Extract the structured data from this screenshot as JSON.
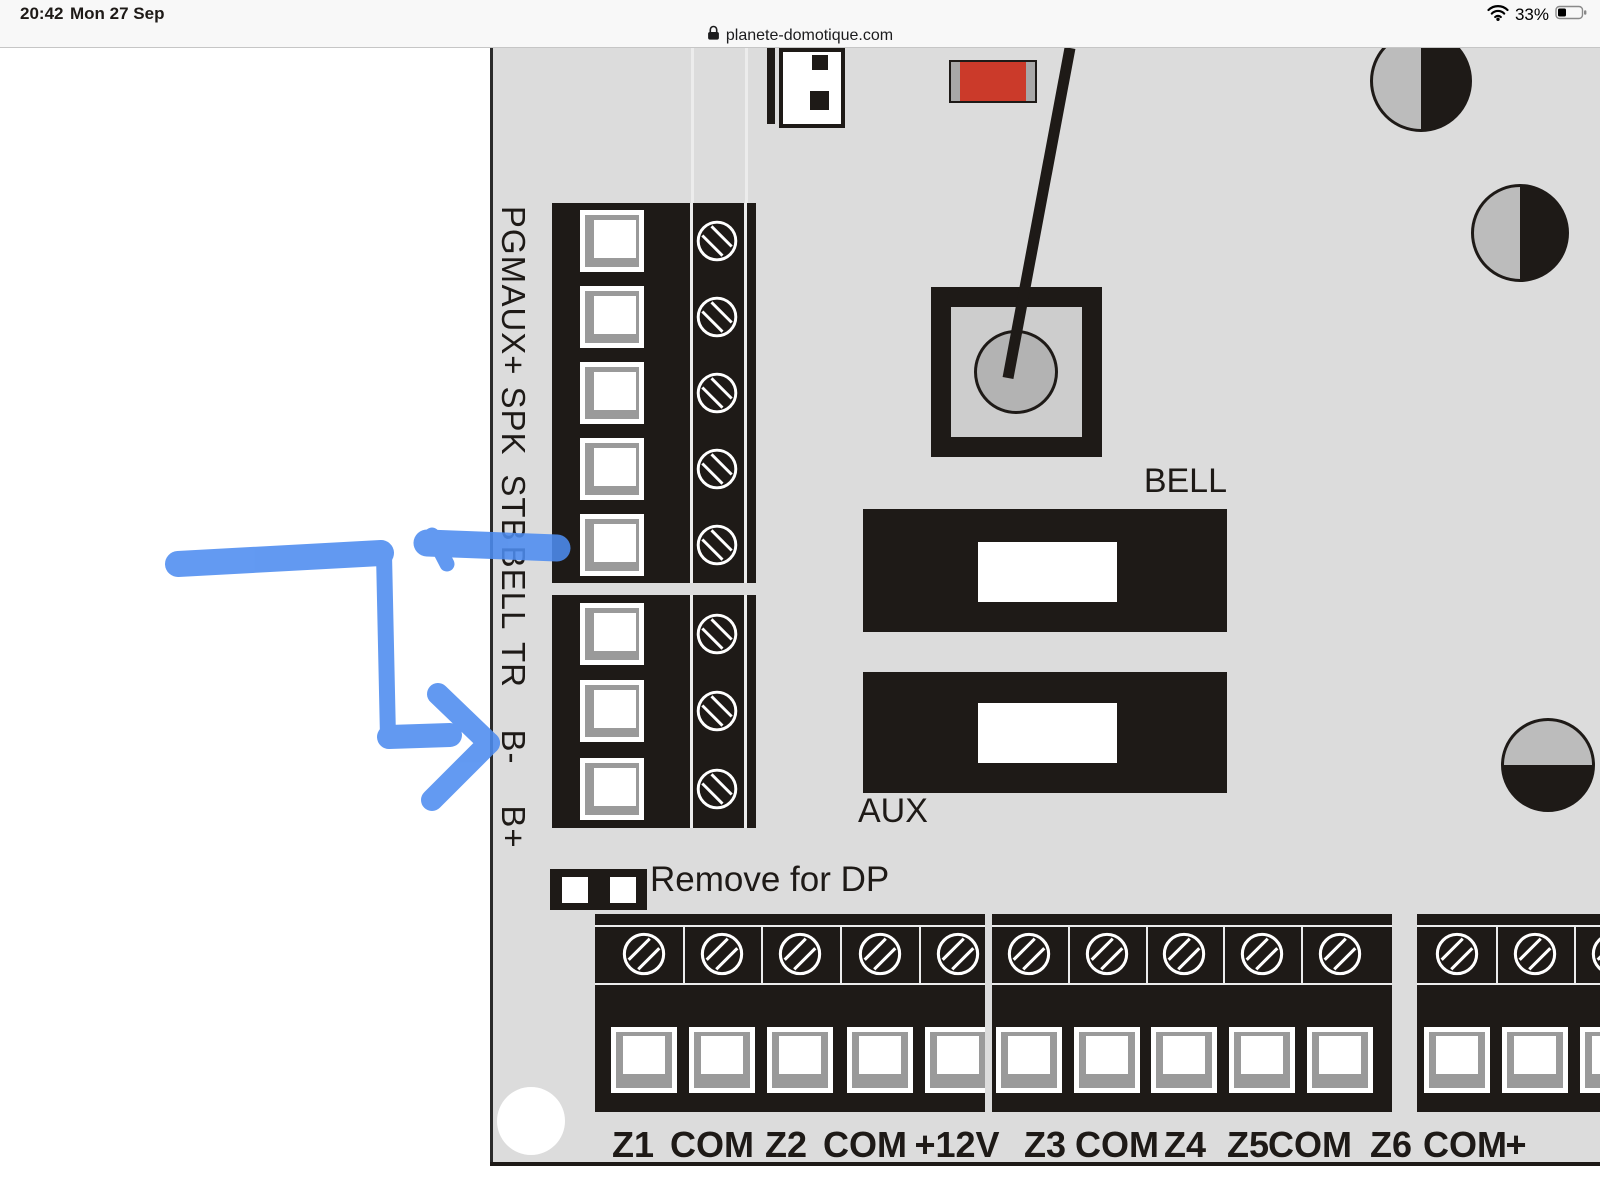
{
  "status_bar": {
    "time": "20:42",
    "date": "Mon 27 Sep",
    "wifi_icon": "wifi-signal",
    "battery_percent": "33%",
    "battery_icon": "battery-one-third"
  },
  "address_bar": {
    "lock_icon": "padlock",
    "domain": "planete-domotique.com"
  },
  "diagram": {
    "side_terminal_labels": [
      "PGM",
      "AUX+",
      "SPK",
      "STB",
      "BELL",
      "TR",
      "B-",
      "B+"
    ],
    "relay_bell_label": "BELL",
    "relay_aux_label": "AUX",
    "jumper_note": "Remove for DP",
    "bottom_terminal_labels": [
      "Z1",
      "COM",
      "Z2",
      "COM",
      "+12V",
      "Z3",
      "COM",
      "Z4",
      "Z5",
      "COM",
      "Z6",
      "COM",
      "+"
    ],
    "colors": {
      "board_background": "#dcdcdc",
      "component_black": "#1e1a17",
      "component_red": "#cb3a2a",
      "frame_grey": "#9a9a9a",
      "hole_grey": "#bcbcbc"
    }
  },
  "annotation": {
    "type": "hand-drawn-arrow",
    "color": "#4d8cf0",
    "description": "blue marker arrow pointing at BELL terminal"
  }
}
